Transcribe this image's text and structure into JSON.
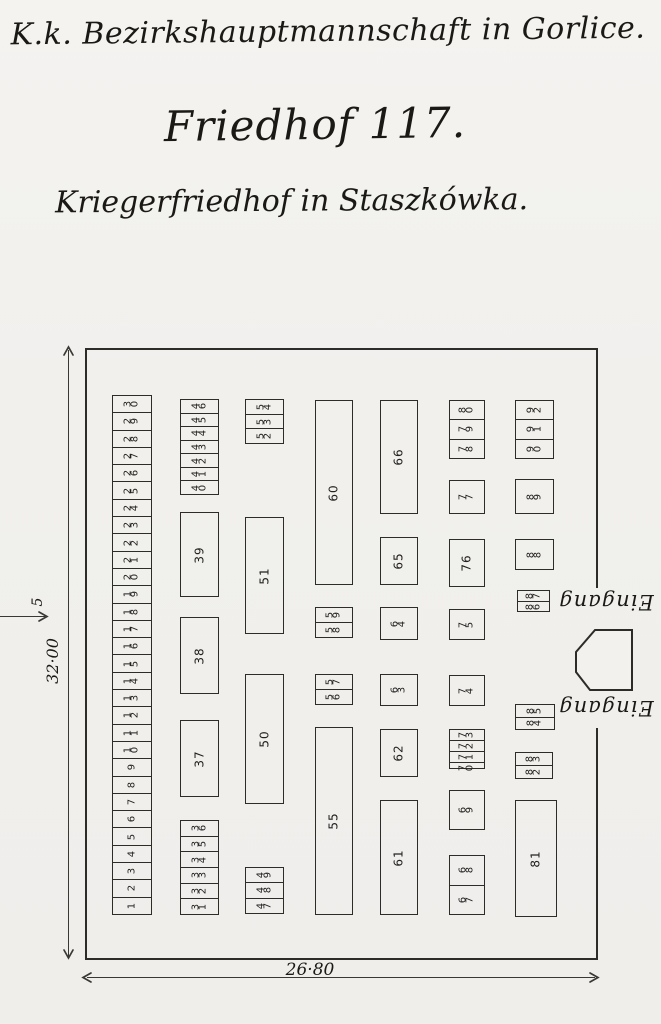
{
  "document": {
    "heading": "K.k. Bezirkshauptmannschaft in Gorlice.",
    "title": "Friedhof 117.",
    "subtitle": "Kriegerfriedhof in Staszkówka."
  },
  "dimensions": {
    "height_label": "32·00",
    "width_label": "26·80",
    "offset_label": "5"
  },
  "entrances": {
    "upper_label": "Eingang",
    "lower_label": "Eingang"
  },
  "colors": {
    "paper": "#f2f1ee",
    "ink": "#2e2c29"
  },
  "plan": {
    "groups": [
      {
        "name": "graves-1-30",
        "type": "strip",
        "x": 25,
        "y": 45,
        "w": 40,
        "h": 520,
        "cells": [
          "30",
          "29",
          "28",
          "27",
          "26",
          "25",
          "24",
          "23",
          "22",
          "21",
          "20",
          "19",
          "18",
          "17",
          "16",
          "15",
          "14",
          "13",
          "12",
          "11",
          "10",
          "9",
          "8",
          "7",
          "6",
          "5",
          "4",
          "3",
          "2",
          "1"
        ]
      },
      {
        "name": "graves-40-46",
        "type": "strip",
        "x": 93,
        "y": 49,
        "w": 39,
        "h": 96,
        "cells": [
          "46",
          "45",
          "44",
          "43",
          "42",
          "41",
          "40"
        ]
      },
      {
        "name": "grave-39",
        "type": "plot",
        "x": 93,
        "y": 162,
        "w": 39,
        "h": 85,
        "number": "39"
      },
      {
        "name": "grave-38",
        "type": "plot",
        "x": 93,
        "y": 267,
        "w": 39,
        "h": 77,
        "number": "38"
      },
      {
        "name": "grave-37",
        "type": "plot",
        "x": 93,
        "y": 370,
        "w": 39,
        "h": 77,
        "number": "37"
      },
      {
        "name": "graves-31-36",
        "type": "strip",
        "x": 93,
        "y": 470,
        "w": 39,
        "h": 95,
        "cells": [
          "36",
          "35",
          "34",
          "33",
          "32",
          "31"
        ]
      },
      {
        "name": "graves-52-54",
        "type": "strip",
        "x": 158,
        "y": 49,
        "w": 39,
        "h": 45,
        "cells": [
          "54",
          "53",
          "52"
        ]
      },
      {
        "name": "grave-51",
        "type": "plot",
        "x": 158,
        "y": 167,
        "w": 39,
        "h": 117,
        "number": "51"
      },
      {
        "name": "grave-50",
        "type": "plot",
        "x": 158,
        "y": 324,
        "w": 39,
        "h": 130,
        "number": "50"
      },
      {
        "name": "graves-47-49",
        "type": "strip",
        "x": 158,
        "y": 517,
        "w": 39,
        "h": 47,
        "cells": [
          "49",
          "48",
          "47"
        ]
      },
      {
        "name": "grave-60",
        "type": "plot",
        "x": 228,
        "y": 50,
        "w": 38,
        "h": 185,
        "number": "60"
      },
      {
        "name": "graves-58-59",
        "type": "strip",
        "x": 228,
        "y": 257,
        "w": 38,
        "h": 31,
        "cells": [
          "59",
          "58"
        ]
      },
      {
        "name": "graves-56-57",
        "type": "strip",
        "x": 228,
        "y": 324,
        "w": 38,
        "h": 31,
        "cells": [
          "57",
          "56"
        ]
      },
      {
        "name": "grave-55",
        "type": "plot",
        "x": 228,
        "y": 377,
        "w": 38,
        "h": 188,
        "number": "55"
      },
      {
        "name": "grave-66",
        "type": "plot",
        "x": 293,
        "y": 50,
        "w": 38,
        "h": 114,
        "number": "66"
      },
      {
        "name": "grave-65",
        "type": "plot",
        "x": 293,
        "y": 187,
        "w": 38,
        "h": 48,
        "number": "65"
      },
      {
        "name": "grave-64",
        "type": "plot",
        "x": 293,
        "y": 257,
        "w": 38,
        "h": 33,
        "number": "64"
      },
      {
        "name": "grave-63",
        "type": "plot",
        "x": 293,
        "y": 324,
        "w": 38,
        "h": 32,
        "number": "63"
      },
      {
        "name": "grave-62",
        "type": "plot",
        "x": 293,
        "y": 379,
        "w": 38,
        "h": 48,
        "number": "62"
      },
      {
        "name": "grave-61",
        "type": "plot",
        "x": 293,
        "y": 450,
        "w": 38,
        "h": 115,
        "number": "61"
      },
      {
        "name": "graves-78-80",
        "type": "strip",
        "x": 362,
        "y": 50,
        "w": 36,
        "h": 59,
        "cells": [
          "80",
          "79",
          "78"
        ]
      },
      {
        "name": "grave-77",
        "type": "plot",
        "x": 362,
        "y": 130,
        "w": 36,
        "h": 34,
        "number": "77"
      },
      {
        "name": "grave-76",
        "type": "plot",
        "x": 362,
        "y": 189,
        "w": 36,
        "h": 48,
        "number": "76"
      },
      {
        "name": "grave-75",
        "type": "plot",
        "x": 362,
        "y": 259,
        "w": 36,
        "h": 31,
        "number": "75"
      },
      {
        "name": "grave-74",
        "type": "plot",
        "x": 362,
        "y": 325,
        "w": 36,
        "h": 31,
        "number": "74"
      },
      {
        "name": "graves-70-73",
        "type": "strip",
        "x": 362,
        "y": 379,
        "w": 36,
        "h": 40,
        "cells": [
          "73",
          "72",
          "71",
          "70"
        ]
      },
      {
        "name": "grave-69",
        "type": "plot",
        "x": 362,
        "y": 440,
        "w": 36,
        "h": 40,
        "number": "69"
      },
      {
        "name": "graves-67-68",
        "type": "strip",
        "x": 362,
        "y": 505,
        "w": 36,
        "h": 60,
        "cells": [
          "68",
          "67"
        ]
      },
      {
        "name": "graves-90-92",
        "type": "strip",
        "x": 428,
        "y": 50,
        "w": 39,
        "h": 59,
        "cells": [
          "92",
          "91",
          "90"
        ]
      },
      {
        "name": "grave-89",
        "type": "plot",
        "x": 428,
        "y": 129,
        "w": 39,
        "h": 35,
        "number": "89"
      },
      {
        "name": "grave-88",
        "type": "plot",
        "x": 428,
        "y": 189,
        "w": 39,
        "h": 31,
        "number": "88"
      },
      {
        "name": "graves-86-87",
        "type": "strip",
        "x": 430,
        "y": 240,
        "w": 33,
        "h": 22,
        "cells": [
          "87",
          "86"
        ]
      },
      {
        "name": "graves-84-85",
        "type": "strip",
        "x": 428,
        "y": 354,
        "w": 40,
        "h": 26,
        "cells": [
          "85",
          "84"
        ]
      },
      {
        "name": "graves-82-83",
        "type": "strip",
        "x": 428,
        "y": 402,
        "w": 38,
        "h": 27,
        "cells": [
          "83",
          "82"
        ]
      },
      {
        "name": "grave-81",
        "type": "plot",
        "x": 428,
        "y": 450,
        "w": 42,
        "h": 117,
        "number": "81"
      }
    ]
  }
}
